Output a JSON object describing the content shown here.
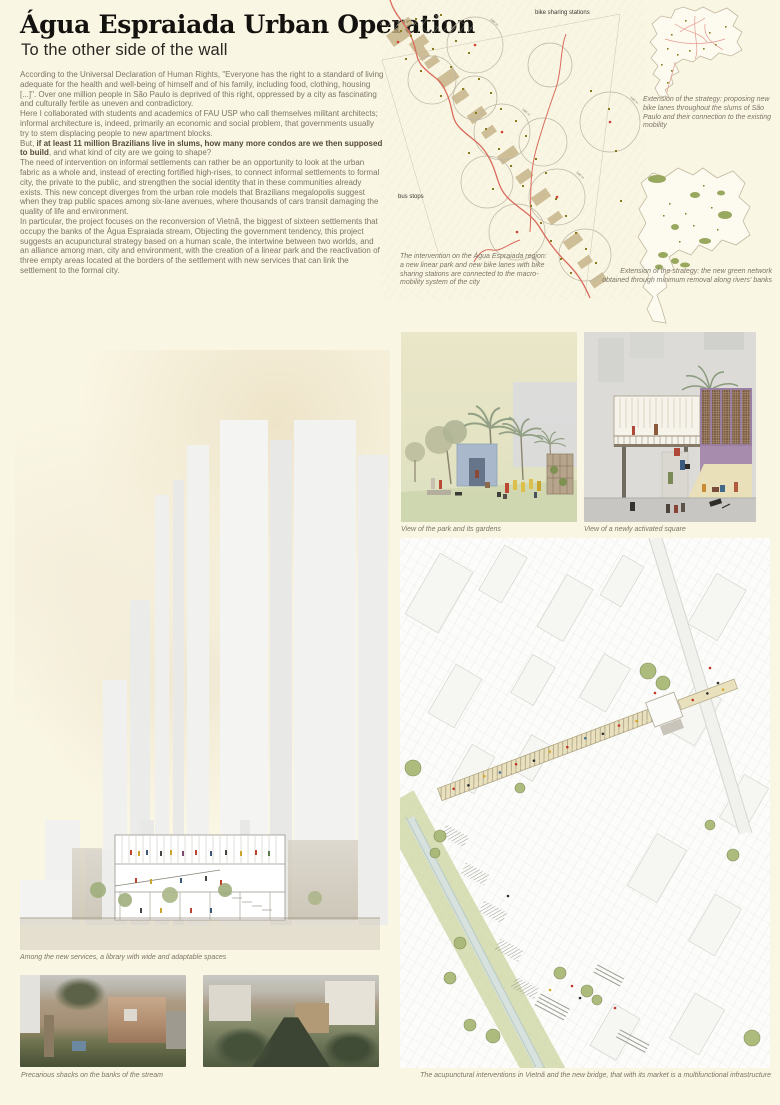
{
  "poster": {
    "title": "Água Espraiada Urban Operation",
    "subtitle": "To the other side of the wall",
    "intro": {
      "p1": "According to the Universal Declaration of Human Rights, \"Everyone has the right to a standard of living adequate for the health and well-being of himself and of his family, including food, clothing, housing [...]\". Over one million people in São Paulo is deprived of this right, oppressed by a city as fascinating and culturally fertile as uneven and contradictory.",
      "p2": "Here I collaborated with students and academics of FAU USP who call themselves militant architects; informal architecture is, indeed, primarily an economic and social problem, that governments usually try to stem displacing people to new apartment blocks.",
      "p3_start": "But, ",
      "p3_bold": "if at least 11 million Brazilians live in slums, how many more condos are we then supposed to build",
      "p3_end": ", and what kind of city are we going to shape?",
      "p4": "The need of intervention on informal settlements can rather be an opportunity to look at the urban fabric as a whole and, instead of erecting fortified high-rises, to connect informal settlements to formal city, the private to the public, and strengthen the social identity that in these communities already exists. This new concept diverges from the urban role models that Brazilians megalopolis suggest when they trap public spaces among six-lane avenues, where thousands of cars transit damaging the quality of life and environment.",
      "p5": "In particular, the project focuses on the reconversion of Vietnã, the biggest of sixteen settlements that occupy the banks of the Água Espraiada stream, Objecting the government tendency, this project suggests an acupunctural strategy based on a human scale, the intertwine between two worlds, and an alliance among man, city and environment, with the creation of a linear park and the reactivation of three empty areas located at the borders of the settlement with new services that can link the settlement to the formal city."
    },
    "mobility_map": {
      "label_bike": "bike sharing stations",
      "label_bus": "bus stops",
      "radius_label": "500 m",
      "caption": "The intervention on the Água Espraiada region: a new linear park and new bike lanes with bike sharing stations are connected to the macro-mobility system of the city"
    },
    "strategy_maps": {
      "map1_caption": "Extension of the strategy: proposing new bike lanes throughout the slums of São Paulo and their connection to the existing mobility",
      "map2_caption": "Extension of the strategy: the new green network obtained through minimum removal along rivers' banks"
    },
    "renders": {
      "park_caption": "View of the park and its gardens",
      "square_caption": "View of a newly activated square"
    },
    "section_caption": "Among the new services, a library with wide and adaptable spaces",
    "photos_caption": "Precarious shacks on the banks of the stream",
    "axo_caption": "The acupunctural interventions in Vietnã and the new bridge, that with its market is a multifunctional infrastructure",
    "colors": {
      "background": "#faf6e4",
      "accent_red": "#d96a5c",
      "olive_dot": "#8a7a1e",
      "map_tan": "#c4b184",
      "green": "#9aae71",
      "purple": "#9b7fa3",
      "blue_pavilion": "#a9b8ca"
    }
  }
}
